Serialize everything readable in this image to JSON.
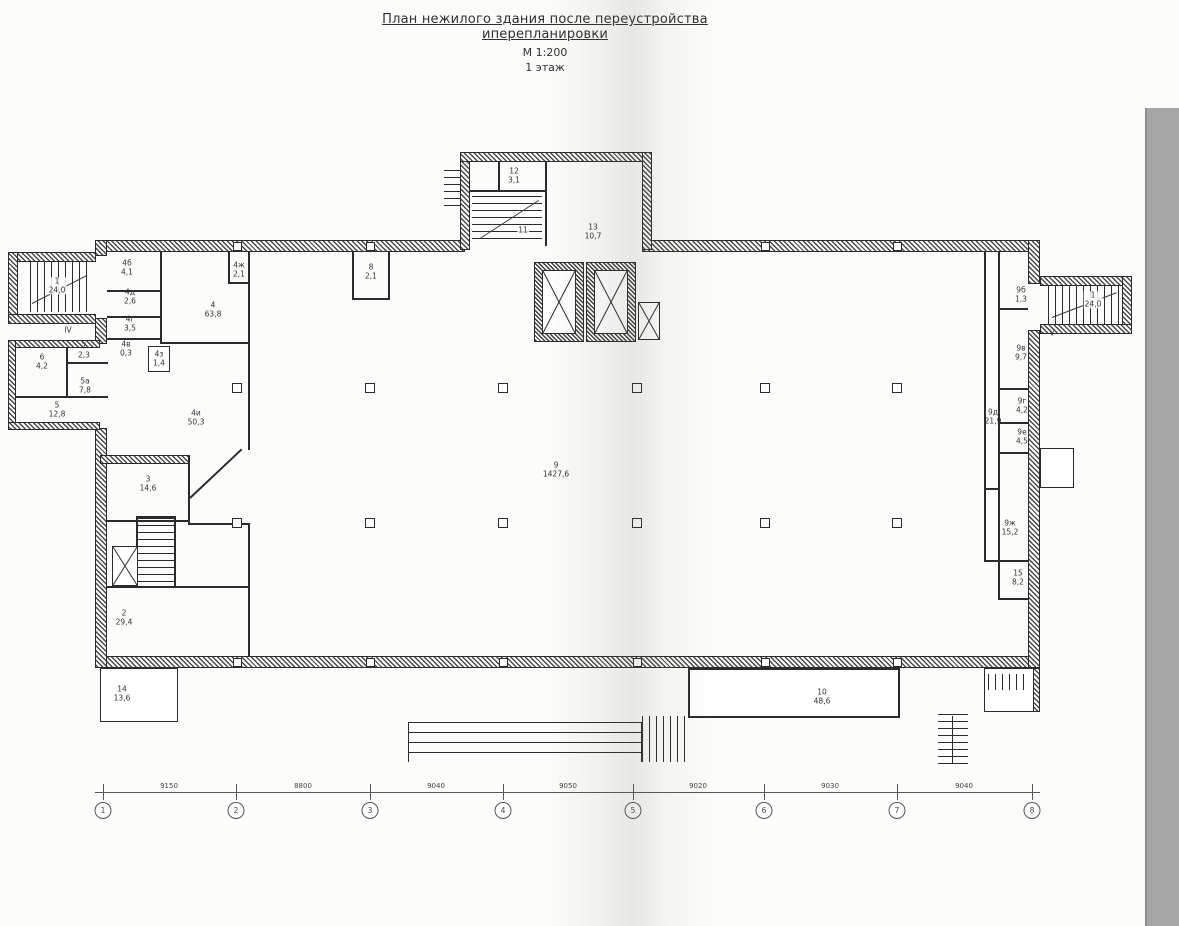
{
  "title": {
    "line1": "План нежилого здания после переустройства иперепланировки",
    "line2": "М 1:200",
    "line3": "1 этаж"
  },
  "rooms": [
    {
      "num": "1",
      "area": "24,0"
    },
    {
      "num": "4б",
      "area": "4,1"
    },
    {
      "num": "4д",
      "area": "2,6"
    },
    {
      "num": "4г",
      "area": "3,5"
    },
    {
      "num": "4в",
      "area": "0,3"
    },
    {
      "num": "4",
      "area": "63,8"
    },
    {
      "num": "4ж",
      "area": "2,1"
    },
    {
      "num": "4з",
      "area": "1,4"
    },
    {
      "num": "4и",
      "area": "50,3"
    },
    {
      "num": "3",
      "area": "14,6"
    },
    {
      "num": "6",
      "area": "4,2"
    },
    {
      "num": "7",
      "area": "2,3"
    },
    {
      "num": "5а",
      "area": "7,8"
    },
    {
      "num": "5",
      "area": "12,8"
    },
    {
      "num": "2",
      "area": "29,4"
    },
    {
      "num": "14",
      "area": "13,6"
    },
    {
      "num": "9",
      "area": "1427,6"
    },
    {
      "num": "8",
      "area": "2,1"
    },
    {
      "num": "13",
      "area": "10,7"
    },
    {
      "num": "12",
      "area": "3,1"
    },
    {
      "num": "11",
      "area": ""
    },
    {
      "num": "1",
      "area": "24,0"
    },
    {
      "num": "9б",
      "area": "1,3"
    },
    {
      "num": "9в",
      "area": "9,7"
    },
    {
      "num": "9г",
      "area": "4,2"
    },
    {
      "num": "9е",
      "area": "4,5"
    },
    {
      "num": "9д",
      "area": "21,9"
    },
    {
      "num": "9ж",
      "area": "15,2"
    },
    {
      "num": "15",
      "area": "8,2"
    },
    {
      "num": "10",
      "area": "48,6"
    },
    {
      "num": "IV",
      "area": ""
    },
    {
      "num": "V",
      "area": ""
    }
  ],
  "axes": {
    "numbers": [
      "1",
      "2",
      "3",
      "4",
      "5",
      "6",
      "7",
      "8"
    ],
    "dims": [
      "9150",
      "8800",
      "9040",
      "9050",
      "9020",
      "9030",
      "9040"
    ]
  },
  "colors": {
    "ink": "#2b2b2b",
    "paper": "#fcfcfa",
    "scan_strip": "#a6a6a6"
  }
}
